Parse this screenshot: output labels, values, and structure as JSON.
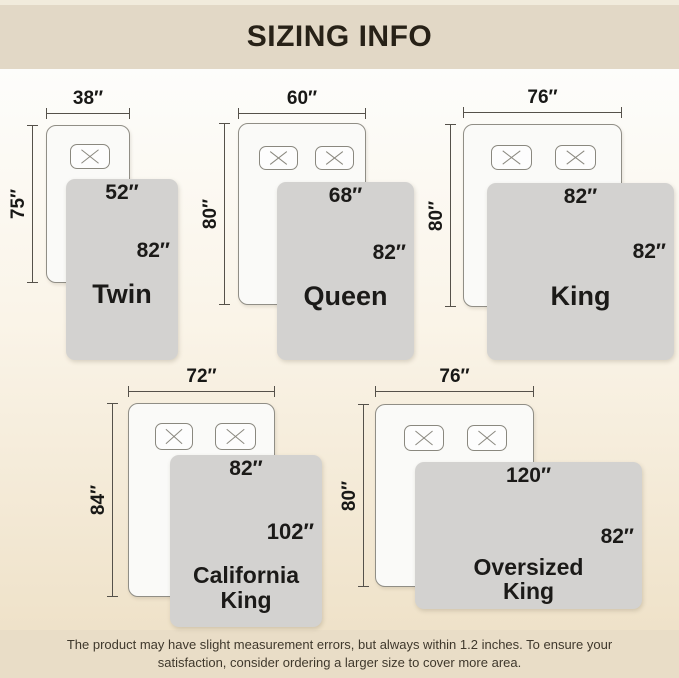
{
  "header": {
    "title": "SIZING INFO"
  },
  "sizes": [
    {
      "name": "Twin",
      "bed_width": "38″",
      "bed_length": "75″",
      "blanket_width": "52″",
      "blanket_length": "82″"
    },
    {
      "name": "Queen",
      "bed_width": "60″",
      "bed_length": "80″",
      "blanket_width": "68″",
      "blanket_length": "82″"
    },
    {
      "name": "King",
      "bed_width": "76″",
      "bed_length": "80″",
      "blanket_width": "82″",
      "blanket_length": "82″"
    },
    {
      "name": "California King",
      "bed_width": "72″",
      "bed_length": "84″",
      "blanket_width": "82″",
      "blanket_length": "102″"
    },
    {
      "name": "Oversized King",
      "bed_width": "76″",
      "bed_length": "80″",
      "blanket_width": "120″",
      "blanket_length": "82″"
    }
  ],
  "footer": {
    "line1": "The product may have slight measurement errors, but always within 1.2 inches. To ensure your",
    "line2": "satisfaction, consider ordering a larger size to cover more area."
  },
  "colors": {
    "header_bg": "#e2d8c6",
    "footer_bg": "#e9ddc7",
    "blanket": "#d3d2d0",
    "dim": "#55514a",
    "ink": "#1b1a18"
  }
}
